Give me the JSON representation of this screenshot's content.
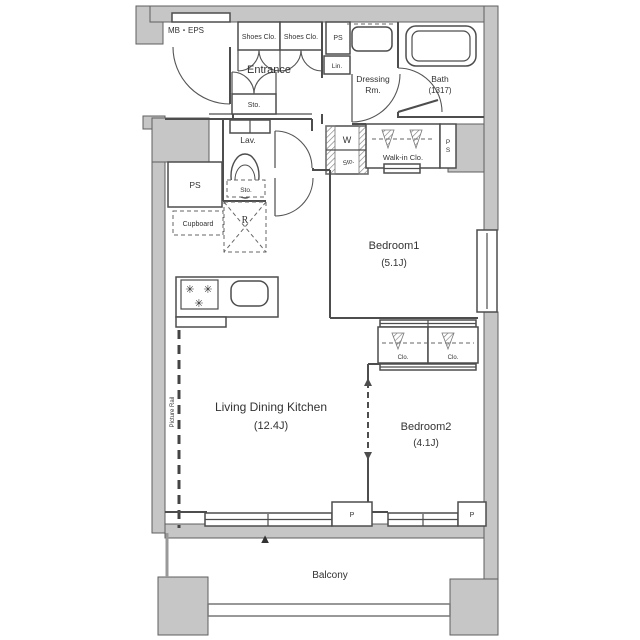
{
  "plan": {
    "type": "apartment-floor-plan",
    "colors": {
      "wall_fill": "#c6c6c6",
      "line": "#4d4d4d",
      "text": "#333333",
      "background": "#ffffff",
      "marker": "#111111"
    },
    "exterior": {
      "meter_box": "MB・EPS",
      "balcony": "Balcony",
      "pillar_1": "P",
      "pillar_2": "P",
      "direction_marker": "▲"
    },
    "entrance": {
      "label": "Entrance",
      "shoes_closet_1": "Shoes Clo.",
      "shoes_closet_2": "Shoes Clo.",
      "pipe_space": "PS",
      "linen": "Lin.",
      "storage": "Sto."
    },
    "sanitary": {
      "dressing_room_line1": "Dressing",
      "dressing_room_line2": "Rm.",
      "bath": "Bath",
      "bath_size": "(1317)",
      "lavatory": "Lav.",
      "lavatory_storage": "Sto.",
      "washer": "W",
      "washer_storage": "Sto.",
      "pipe_space_p": "P",
      "pipe_space_s": "S"
    },
    "storage": {
      "walk_in_closet": "Walk-in Clo.",
      "pipe_space": "PS",
      "cupboard": "Cupboard",
      "refrigerator": "R",
      "closet_1": "Clo.",
      "closet_2": "Clo."
    },
    "rooms": {
      "bedroom1": {
        "name": "Bedroom1",
        "size": "(5.1J)"
      },
      "bedroom2": {
        "name": "Bedroom2",
        "size": "(4.1J)"
      },
      "ldk": {
        "name": "Living Dining Kitchen",
        "size": "(12.4J)"
      }
    },
    "kitchen": {
      "burner_symbol": "✳"
    },
    "annotations": {
      "picture_rail": "Picture Rail"
    }
  }
}
